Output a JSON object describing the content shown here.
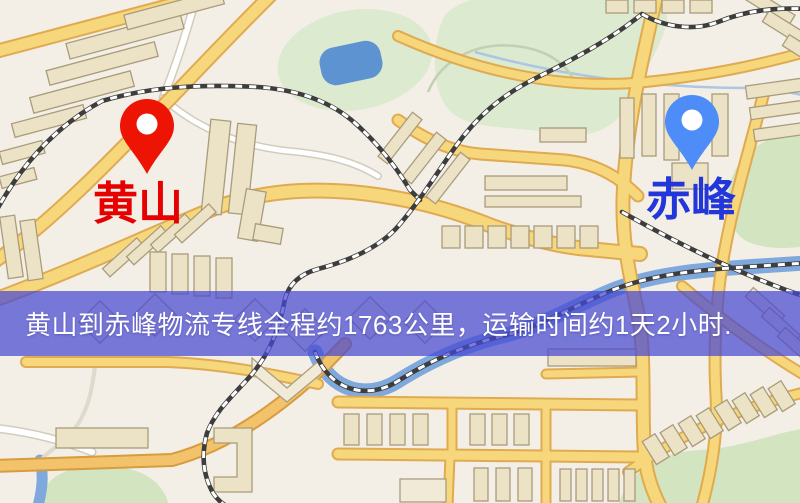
{
  "banner": {
    "text": "黄山到赤峰物流专线全程约1763公里，运输时间约1天2小时.",
    "background_color": "#4648d2",
    "text_color": "#ffffff"
  },
  "origin": {
    "label": "黄山",
    "label_color": "#e60000",
    "pin_color": "#ee1404",
    "pin_icon": "red-map-pin"
  },
  "destination": {
    "label": "赤峰",
    "label_color": "#2336d9",
    "pin_color": "#4e8cf7",
    "pin_icon": "blue-map-pin"
  },
  "map": {
    "background_color": "#f3efe6",
    "road_color": "#f7d77c",
    "water_color": "#5e93d2",
    "park_color": "#dcead0",
    "railway_color": "#3d3d3d",
    "building_color": "#ece2c6"
  }
}
